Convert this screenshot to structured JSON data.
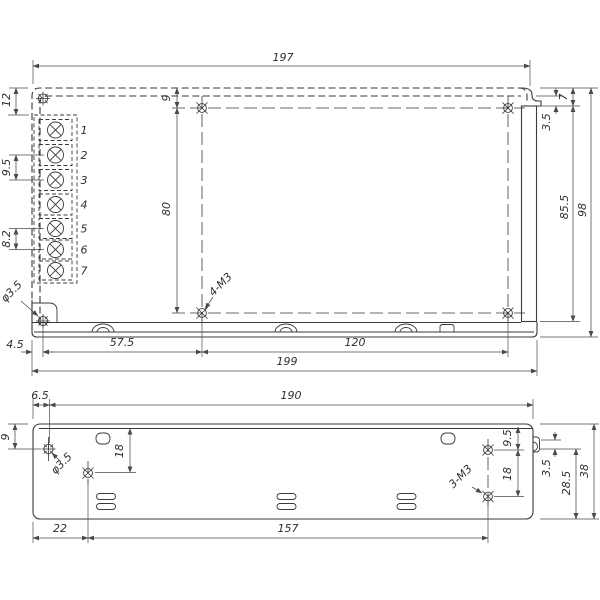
{
  "drawing": {
    "background": "#ffffff",
    "line_color": "#3a3a3a",
    "views": {
      "top": {
        "dims": {
          "width_body": "197",
          "terminal_offset_top": "12",
          "terminal_pitch_input": "9.5",
          "terminal_pitch_output": "8.2",
          "corner_hole": "φ3.5",
          "hole_offset_top": "9",
          "hole_spacing_vertical": "80",
          "mounting_holes": "4-M3",
          "flange_inset": "3.5",
          "flange_top_offset": "7",
          "flange_length": "85.5",
          "height_total": "98",
          "corner_hole_offset": "4.5",
          "hole_offset_left": "57.5",
          "hole_spacing_horizontal": "120",
          "width_total": "199"
        },
        "terminals": [
          "1",
          "2",
          "3",
          "4",
          "5",
          "6",
          "7"
        ]
      },
      "side": {
        "dims": {
          "corner_hole_offset_left": "6.5",
          "width_body": "190",
          "corner_hole_offset_top": "9",
          "hole_offset_top_left": "18",
          "corner_hole": "φ3.5",
          "mounting_holes": "3-M3",
          "hole_offset_top_right": "9.5",
          "hole_spacing_right": "18",
          "slot_offset": "3.5",
          "hole_offset_bottom": "28.5",
          "height_total": "38",
          "hole_offset_bottom_left": "22",
          "hole_spacing_bottom": "157"
        }
      }
    }
  }
}
